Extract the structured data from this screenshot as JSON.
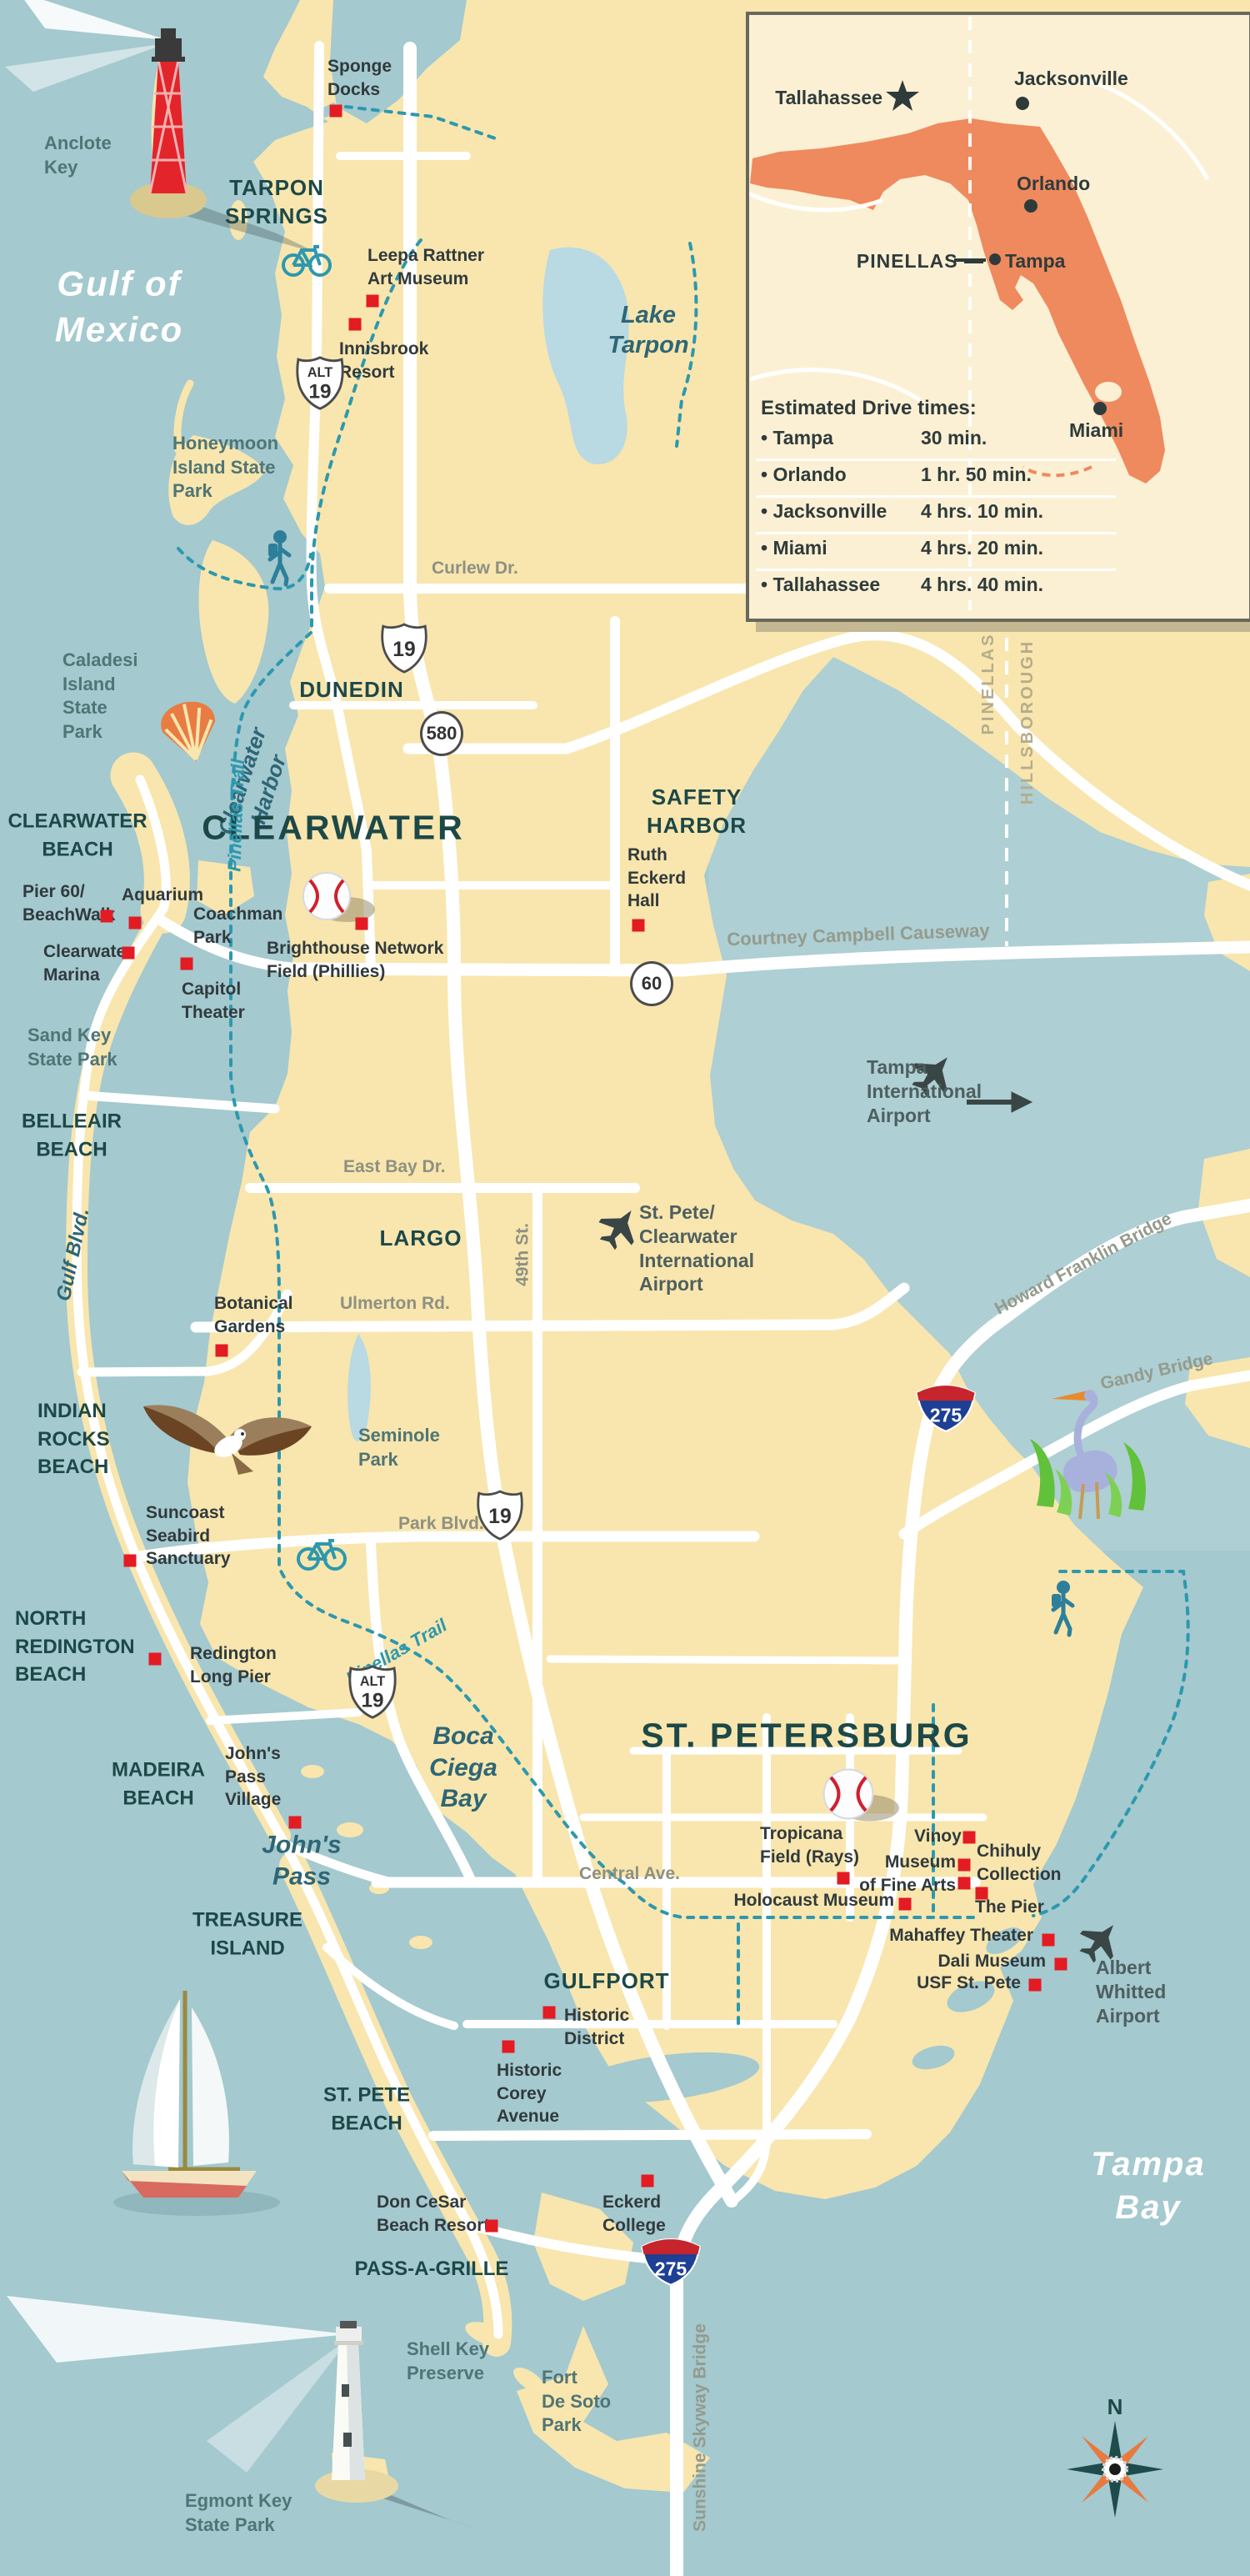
{
  "compass": {
    "north": "N"
  },
  "inset": {
    "cities": {
      "tallahassee": "Tallahassee",
      "jacksonville": "Jacksonville",
      "orlando": "Orlando",
      "tampa": "Tampa",
      "miami": "Miami"
    },
    "county_label": "PINELLAS —",
    "drive_times": {
      "title": "Estimated Drive times:",
      "rows": [
        {
          "city": "• Tampa",
          "time": "30 min."
        },
        {
          "city": "• Orlando",
          "time": "1 hr. 50 min."
        },
        {
          "city": "• Jacksonville",
          "time": "4 hrs. 10 min."
        },
        {
          "city": "• Miami",
          "time": "4 hrs. 20 min."
        },
        {
          "city": "• Tallahassee",
          "time": "4 hrs. 40 min."
        }
      ]
    }
  },
  "water_labels": {
    "gulf_of_mexico": "Gulf of\nMexico",
    "tampa_bay": "Tampa\nBay",
    "lake_tarpon": "Lake\nTarpon",
    "clearwater_harbor": "Clearwater\nHarbor",
    "boca_ciega_bay": "Boca\nCiega\nBay",
    "johns_pass": "John's\nPass"
  },
  "city_labels": {
    "tarpon_springs": "TARPON\nSPRINGS",
    "dunedin": "DUNEDIN",
    "clearwater": "CLEARWATER",
    "safety_harbor": "SAFETY\nHARBOR",
    "largo": "LARGO",
    "st_petersburg": "ST. PETERSBURG",
    "gulfport": "GULFPORT",
    "clearwater_beach": "CLEARWATER\nBEACH",
    "belleair_beach": "BELLEAIR\nBEACH",
    "indian_rocks_beach": "INDIAN\nROCKS\nBEACH",
    "north_redington_beach": "NORTH\nREDINGTON\nBEACH",
    "madeira_beach": "MADEIRA\nBEACH",
    "treasure_island": "TREASURE\nISLAND",
    "st_pete_beach": "ST. PETE\nBEACH",
    "pass_a_grille": "PASS-A-GRILLE"
  },
  "park_labels": {
    "anclote_key": "Anclote\nKey",
    "honeymoon_island": "Honeymoon\nIsland State\nPark",
    "caladesi_island": "Caladesi\nIsland\nState\nPark",
    "sand_key": "Sand Key\nState Park",
    "seminole_park": "Seminole\nPark",
    "shell_key": "Shell Key\nPreserve",
    "fort_de_soto": "Fort\nDe Soto\nPark",
    "egmont_key": "Egmont Key\nState Park"
  },
  "attraction_labels": {
    "sponge_docks": "Sponge\nDocks",
    "leepa_rattner": "Leepa Rattner\nArt Museum",
    "innisbrook": "Innisbrook\nResort",
    "pier_60": "Pier 60/\nBeachWalk",
    "aquarium": "Aquarium",
    "clearwater_marina": "Clearwater\nMarina",
    "coachman_park": "Coachman\nPark",
    "capitol_theater": "Capitol\nTheater",
    "brighthouse": "Brighthouse Network\nField (Phillies)",
    "ruth_eckerd": "Ruth\nEckerd\nHall",
    "botanical_gardens": "Botanical\nGardens",
    "suncoast_seabird": "Suncoast\nSeabird\nSanctuary",
    "redington_long_pier": "Redington\nLong Pier",
    "johns_pass_village": "John's\nPass\nVillage",
    "tropicana_field": "Tropicana\nField (Rays)",
    "vinoy": "Vinoy",
    "chihuly": "Chihuly\nCollection",
    "museum_fine_arts": "Museum\nof Fine Arts",
    "the_pier": "The Pier",
    "holocaust_museum": "Holocaust Museum",
    "mahaffey_theater": "Mahaffey Theater",
    "dali_museum": "Dali Museum",
    "usf_st_pete": "USF St. Pete",
    "historic_district": "Historic\nDistrict",
    "historic_corey": "Historic\nCorey\nAvenue",
    "don_cesar": "Don CeSar\nBeach Resort",
    "eckerd_college": "Eckerd\nCollege"
  },
  "airport_labels": {
    "tampa_international": "Tampa\nInternational\nAirport",
    "st_pete_clearwater": "St. Pete/\nClearwater\nInternational\nAirport",
    "albert_whitted": "Albert\nWhitted\nAirport"
  },
  "road_labels": {
    "curlew": "Curlew Dr.",
    "courtney_campbell": "Courtney Campbell Causeway",
    "east_bay": "East Bay Dr.",
    "ulmerton": "Ulmerton Rd.",
    "forty_ninth": "49th St.",
    "park_blvd": "Park Blvd.",
    "central_ave": "Central Ave.",
    "gulf_blvd": "Gulf Blvd.",
    "howard_franklin": "Howard Franklin Bridge",
    "gandy": "Gandy Bridge",
    "sunshine_skyway": "Sunshine Skyway Bridge"
  },
  "trail_labels": {
    "pinellas_trail_north": "Pinellas Trail",
    "pinellas_trail_south": "Pinellas Trail"
  },
  "county_labels": {
    "pinellas": "PINELLAS",
    "hillsborough": "HILLSBOROUGH"
  },
  "highway_shields": {
    "us19": "19",
    "alt": "ALT",
    "alt19": "19",
    "sr580": "580",
    "sr60": "60",
    "i275": "275"
  }
}
